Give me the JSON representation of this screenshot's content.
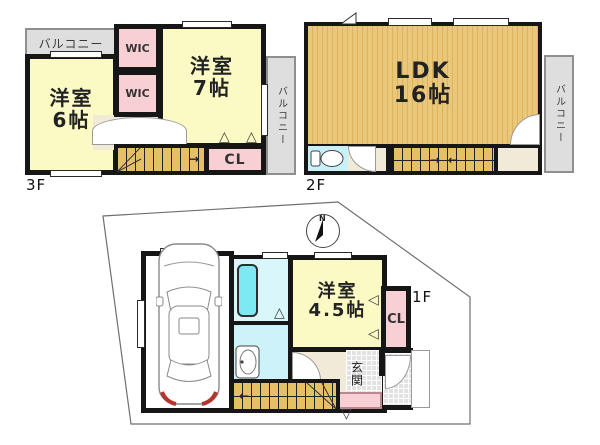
{
  "f3": {
    "label": "3F",
    "balcony_top": "バルコニー",
    "balcony_side": "バルコニー",
    "wic_upper": "WIC",
    "wic_lower": "WIC",
    "room_west_name": "洋室",
    "room_west_size": "6帖",
    "room_east_name": "洋室",
    "room_east_size": "7帖",
    "closet": "CL"
  },
  "f2": {
    "label": "2F",
    "ldk_name": "LDK",
    "ldk_size": "16帖",
    "balcony_side": "バルコニー"
  },
  "f1": {
    "label": "1F",
    "room_name": "洋室",
    "room_size": "4.5帖",
    "closet": "CL",
    "entrance": "玄関",
    "compass_north": "N"
  },
  "icons": {
    "arrow_right": "→",
    "arrow_left": "←",
    "tri_up": "△",
    "tri_down": "▽",
    "tri_left": "◁"
  },
  "colors": {
    "wall": "#161616",
    "room_yellow": "#FBF9C4",
    "closet_pink": "#F8CFD3",
    "wood_floor": "#E9C87B",
    "stairs": "#E5C067",
    "balcony_gray": "#DEDEDE",
    "bath_cyan": "#D9F7FB",
    "bathtub_cyan": "#7DE9F2",
    "hall_beige": "#F1EAD9",
    "tile_gray": "#E2E2E2"
  }
}
